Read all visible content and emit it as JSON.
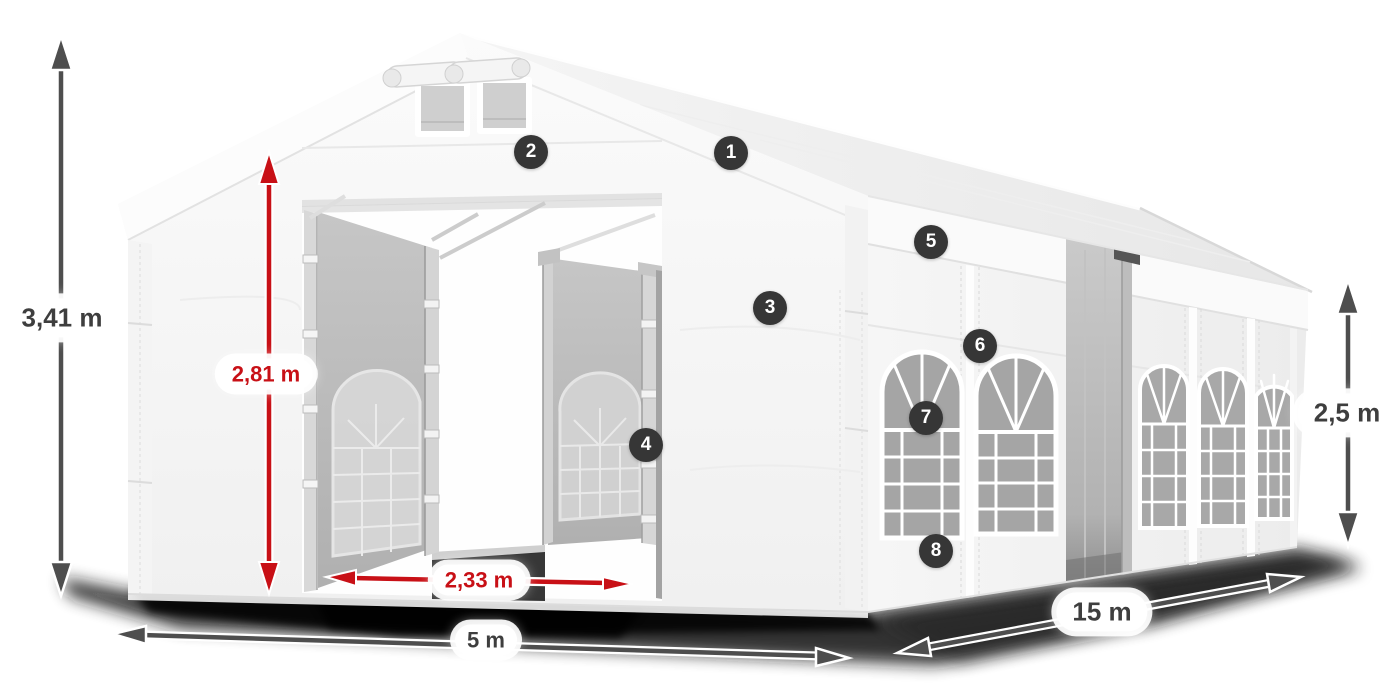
{
  "dimensions": {
    "total_height": {
      "label": "3,41 m",
      "style": "gray"
    },
    "entrance_height": {
      "label": "2,81 m",
      "style": "red"
    },
    "entrance_width": {
      "label": "2,33 m",
      "style": "red"
    },
    "front_width": {
      "label": "5 m",
      "style": "gray"
    },
    "side_length": {
      "label": "15 m",
      "style": "gray"
    },
    "side_height": {
      "label": "2,5 m",
      "style": "gray"
    }
  },
  "callouts": {
    "badges": [
      "1",
      "2",
      "3",
      "4",
      "5",
      "6",
      "7",
      "8"
    ]
  },
  "colors": {
    "accent_red": "#c81016",
    "arrow_gray": "#4e4e4e",
    "badge_background": "#363636",
    "label_text": "#3e3e3e",
    "canvas_background": "#ffffff"
  }
}
